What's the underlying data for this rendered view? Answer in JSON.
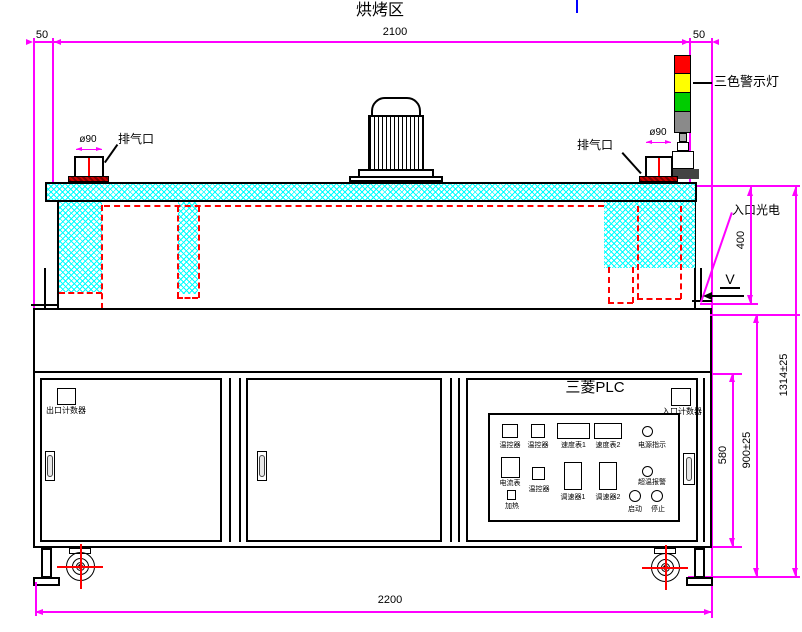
{
  "drawing": {
    "title": "烘烤区",
    "labels": {
      "exhaust_left": "排气口",
      "exhaust_left_diameter": "ø90",
      "exhaust_right": "排气口",
      "exhaust_right_diameter": "ø90",
      "tricolor_light": "三色警示灯",
      "entry_sensor": "入口光电",
      "belt_direction": "V",
      "plc_brand": "三菱PLC",
      "exit_counter": "出口计数器",
      "entry_counter": "入口计数器"
    },
    "dimensions": {
      "left_overhang": "50",
      "oven_zone_width": "2100",
      "right_overhang": "50",
      "chamber_height": "400",
      "cabinet_height": "580",
      "table_height": "900±25",
      "total_height": "1314±25",
      "total_width": "2200"
    },
    "panel": {
      "items": [
        {
          "label": "温控器"
        },
        {
          "label": "温控器"
        },
        {
          "label": "速度表1"
        },
        {
          "label": "速度表2"
        },
        {
          "label": "电源指示"
        },
        {
          "label": "电流表"
        },
        {
          "label": "温控器"
        },
        {
          "label": "调速器1"
        },
        {
          "label": "调速器2"
        },
        {
          "label": "超温报警"
        },
        {
          "label": "加热"
        },
        {
          "label": "启动"
        },
        {
          "label": "停止"
        }
      ]
    },
    "colors": {
      "dimension_line": "#FF00FF",
      "insulation_hatch": "#00FFFF",
      "heater_dashed": "#FF0000",
      "light_red": "#FF0000",
      "light_yellow": "#FFFF00",
      "light_green": "#00CC00",
      "light_body_gray": "#8A8A8A",
      "top_mark_blue": "#0000FF"
    }
  }
}
